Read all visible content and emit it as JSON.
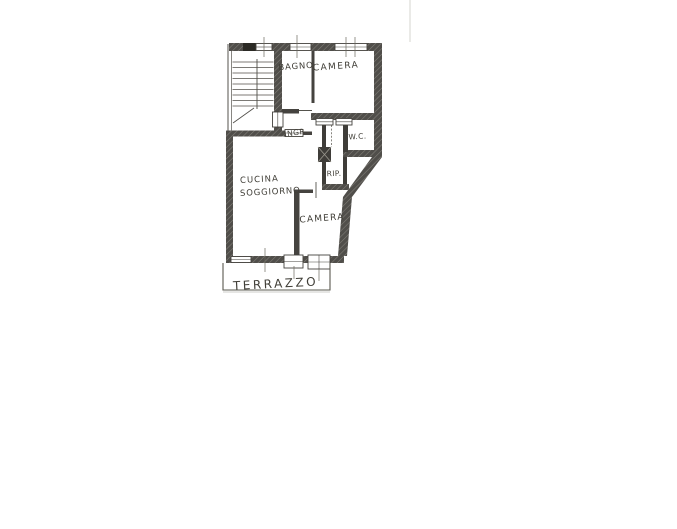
{
  "colors": {
    "paper": "#ffffff",
    "ink": "#403e37",
    "wall_dark": "#4f4d49",
    "wall_thin": "#45433f",
    "scan_artifact": "#dbdbd7"
  },
  "floor_plan": {
    "labels": {
      "bagno": "BAGNO",
      "camera_top": "CAMERA",
      "ingresso": "INGR.",
      "wc": "W.C.",
      "ripostiglio": "RIP.",
      "cucina_line1": "CUCINA",
      "cucina_line2": "SOGGIORNO",
      "camera_bottom": "CAMERA",
      "terrazzo": "TERRAZZO"
    }
  }
}
